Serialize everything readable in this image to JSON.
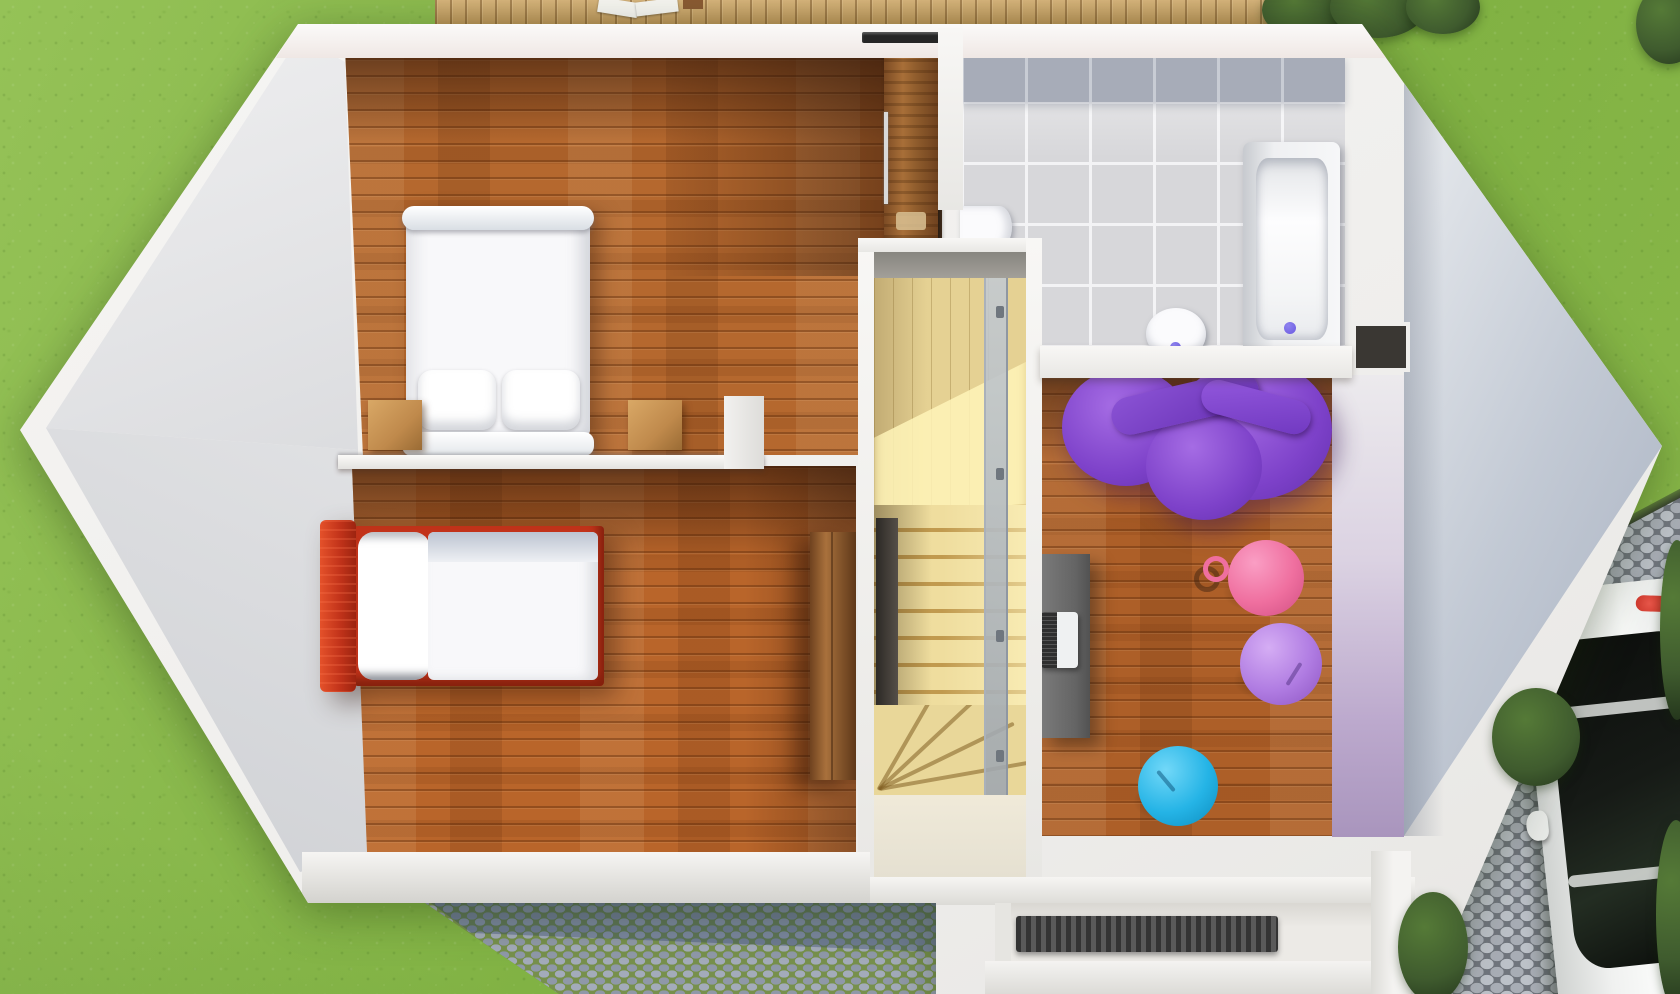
{
  "scene": {
    "kind": "3d-floorplan-render",
    "view": "top-down",
    "level": "upper-floor"
  },
  "colors": {
    "grass": "#8cba4d",
    "foliage": "#3f5b2e",
    "deck": "#c9a263",
    "cobble_moss": "#77904c",
    "driveway_joint": "#70757d",
    "wall": "#efeeec",
    "wall_face": "#c2c9d4",
    "wood": "#b5682e",
    "stair_wood": "#e5d193",
    "tile": "#d7d7da",
    "tile_band": "#a7acb8",
    "porch": "#eceae6",
    "mat": "#343434",
    "duvet": "#f8f8fa",
    "pillow": "#ffffff",
    "bed_red": "#c2331a",
    "nightstand": "#c08a4c",
    "fixture": "#fbfbfd",
    "drain": "#6a5ae0",
    "sofa": "#7d41c9",
    "ball_pink": "#ef6f9f",
    "ball_lavender": "#b07ce2",
    "ball_blue": "#25b4e6",
    "desk": "#646464",
    "laptop": "#eff1f2",
    "car_body": "#f0f1f0",
    "car_glass": "#161a16",
    "taillight": "#c4281e"
  },
  "yard": {
    "features": [
      "lawn",
      "wood-deck",
      "cobblestone-path",
      "cobblestone-driveway",
      "hedges",
      "parked-car"
    ]
  },
  "house": {
    "shape": "elongated-hexagon",
    "rooms": [
      {
        "name": "bedroom-master",
        "floor": "wood",
        "furniture": [
          "double-bed",
          "two-pillows",
          "two-nightstands",
          "sliding-door-closet"
        ]
      },
      {
        "name": "bedroom-kids",
        "floor": "wood",
        "furniture": [
          "red-single-bed",
          "wardrobe"
        ]
      },
      {
        "name": "bathroom",
        "floor": "gray-tile",
        "furniture": [
          "bathtub",
          "toilet",
          "wall-sink",
          "niche"
        ]
      },
      {
        "name": "stairwell",
        "floor": "light-wood",
        "furniture": [
          "straight-flight",
          "winder-steps",
          "glass-balustrade"
        ]
      },
      {
        "name": "playroom",
        "floor": "wood",
        "furniture": [
          "purple-bean-bag",
          "desk",
          "laptop",
          "pink-gym-ball",
          "lavender-gym-ball",
          "blue-gym-ball"
        ]
      },
      {
        "name": "entry-porch",
        "floor": "stone",
        "furniture": [
          "ribbed-doormat"
        ]
      }
    ]
  }
}
